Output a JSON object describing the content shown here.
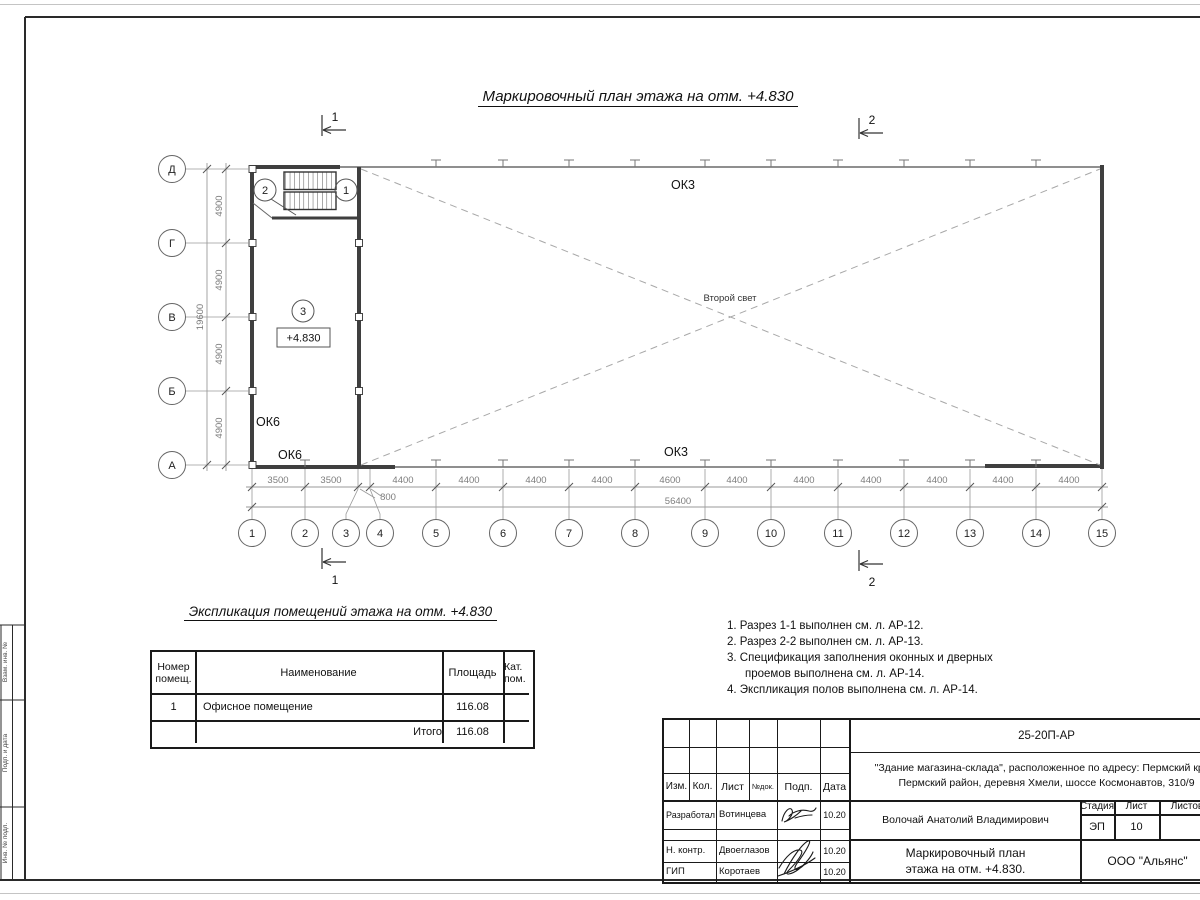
{
  "sheet": {
    "plan_title": "Маркировочный план этажа на отм. +4.830",
    "exp_title": "Экспликация помещений этажа на отм. +4.830"
  },
  "plan": {
    "axes_left": [
      "Д",
      "Г",
      "В",
      "Б",
      "А"
    ],
    "axes_bottom": [
      "1",
      "2",
      "3",
      "4",
      "5",
      "6",
      "7",
      "8",
      "9",
      "10",
      "11",
      "12",
      "13",
      "14",
      "15"
    ],
    "dims_bottom": [
      "3500",
      "3500",
      "800",
      "4400",
      "4400",
      "4400",
      "4400",
      "4600",
      "4400",
      "4400",
      "4400",
      "4400",
      "4400",
      "4400"
    ],
    "dim_total_bottom": "56400",
    "dims_left": [
      "4900",
      "4900",
      "4900",
      "4900"
    ],
    "dim_total_left": "19600",
    "labels": {
      "ok3_top": "ОК3",
      "ok3_bottom": "ОК3",
      "ok6_upper": "ОК6",
      "ok6_lower": "ОК6",
      "second_light": "Второй свет",
      "room_number": "3",
      "elevation": "+4.830",
      "stair_tag_left": "2",
      "stair_tag_right": "1"
    },
    "sections": {
      "s1": "1",
      "s2": "2"
    }
  },
  "exp_table": {
    "col_num_l1": "Номер",
    "col_num_l2": "помещ.",
    "col_name": "Наименование",
    "col_area": "Площадь",
    "col_cat_l1": "Кат.",
    "col_cat_l2": "пом.",
    "row1": {
      "num": "1",
      "name": "Офисное помещение",
      "area": "116.08"
    },
    "total": {
      "label": "Итого",
      "area": "116.08"
    }
  },
  "notes": {
    "line1": "1. Разрез 1-1 выполнен см. л. АР-12.",
    "line2": "2. Разрез 2-2 выполнен см. л. АР-13.",
    "line3": "3. Спецификация заполнения оконных и дверных",
    "line4": "проемов выполнена см. л. АР-14.",
    "line5": "4. Экспликация полов выполнена см. л. АР-14."
  },
  "title_block": {
    "doc_code": "25-20П-АР",
    "address_line1": "\"Здание магазина-склада\", расположенное по адресу: Пермский край,",
    "address_line2": "Пермский район, деревня Хмели, шоссе Космонавтов, 310/9",
    "col_izm": "Изм.",
    "col_kol": "Кол.",
    "col_list": "Лист",
    "col_ndok": "№док.",
    "col_podp": "Подп.",
    "col_data": "Дата",
    "row_developed_label": "Разработал",
    "row_developed_name": "Вотинцева",
    "row_ncontr_label": "Н. контр.",
    "row_ncontr_name": "Двоеглазов",
    "row_gip_label": "ГИП",
    "row_gip_name": "Коротаев",
    "date1": "10.20",
    "date2": "10.20",
    "date3": "10.20",
    "chief_name": "Волочай Анатолий Владимирович",
    "stage_label": "Стадия",
    "sheet_label": "Лист",
    "sheets_label": "Листов",
    "stage_value": "ЭП",
    "sheet_value": "10",
    "drawing_name_line1": "Маркировочный план",
    "drawing_name_line2": "этажа на отм. +4.830.",
    "org_name": "ООО \"Альянс\""
  },
  "side_stamp": {
    "cell1": "Взам. инв. №",
    "cell2": "Подп. и дата",
    "cell3": "Инв. № подл."
  },
  "style": {
    "wall_color": "#3f3f3f",
    "thin_line": "#9a9a9a",
    "dim_text": "#7d7d7d"
  }
}
